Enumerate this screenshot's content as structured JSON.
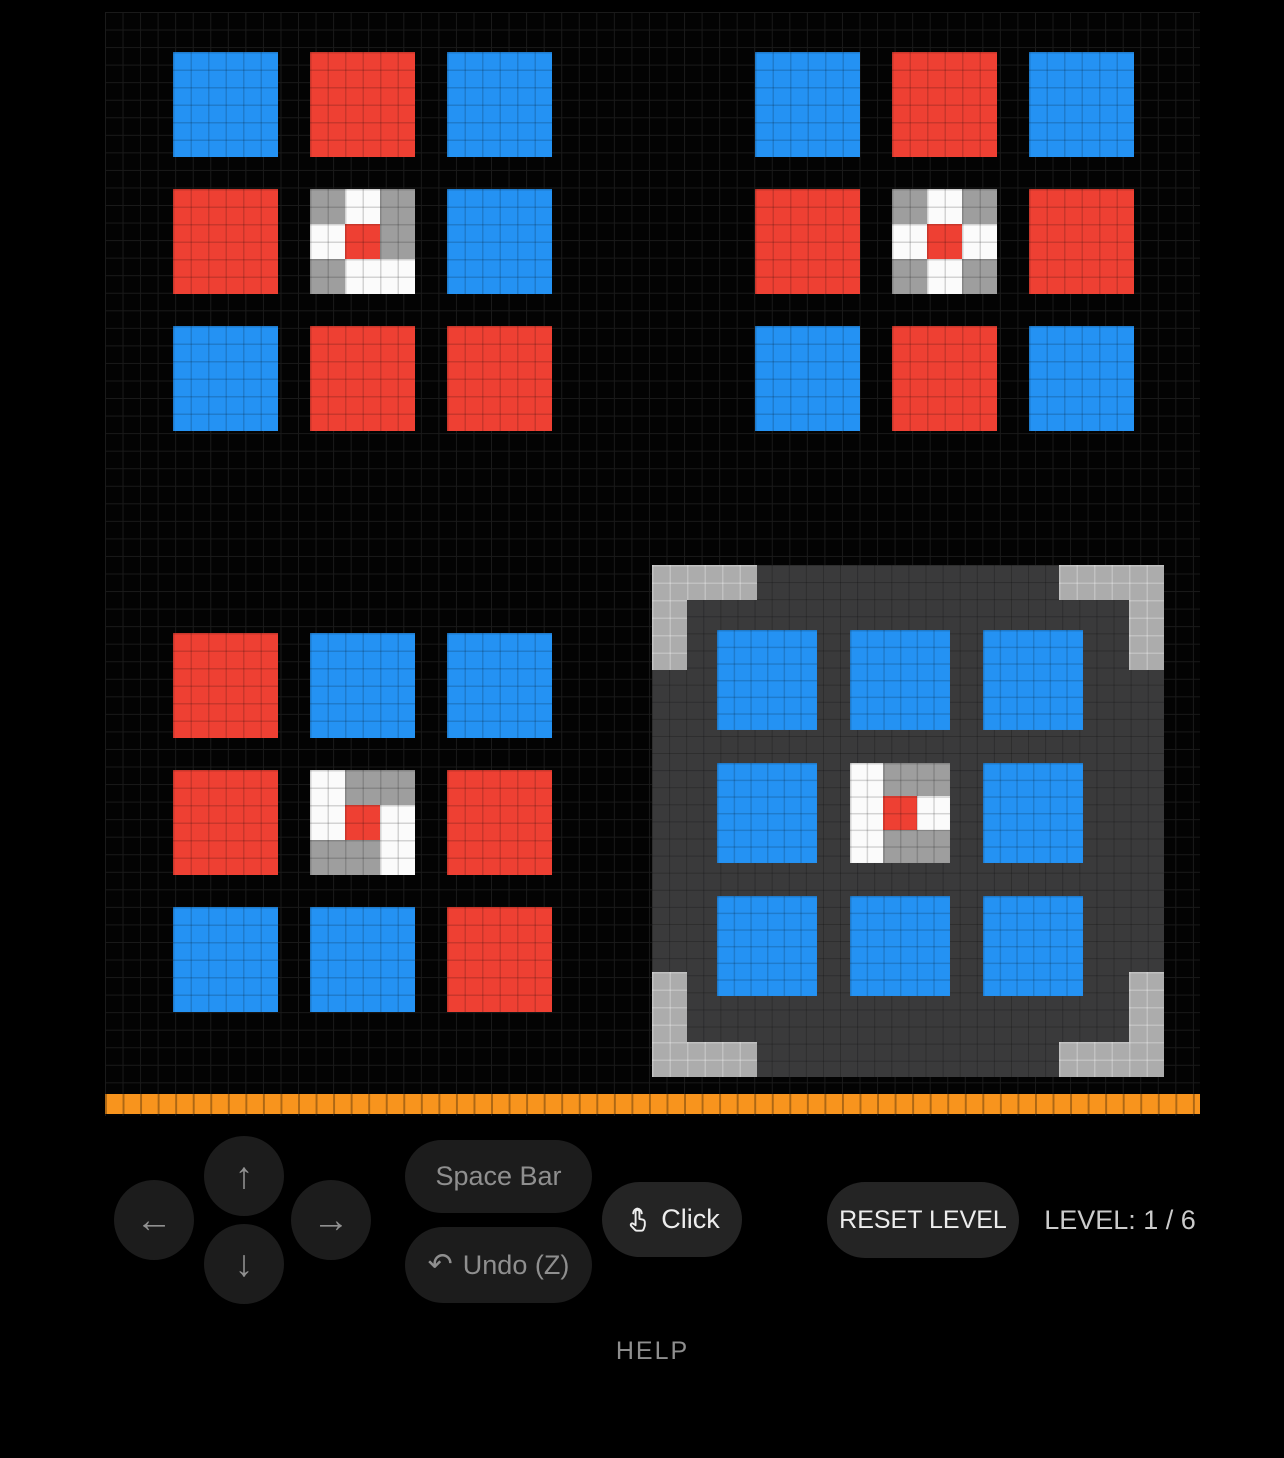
{
  "colors": {
    "background": "#000000",
    "grid_line": "#1a1a1a",
    "blue": "#2492f3",
    "red": "#ee4033",
    "orange": "#f8941d",
    "panel": "#3a3a3b",
    "bracket": "#acacac"
  },
  "tile_palette": {
    "B": "#2492f3",
    "R": "#ee4033"
  },
  "spinner_palette": {
    "W": "#fbfbfb",
    "G": "#9e9e9e",
    "R": "#ee4033"
  },
  "boards": [
    {
      "name": "pattern-board-top-left",
      "interactable": false,
      "tile_size": 105,
      "tile_pitch": 137,
      "cells": [
        [
          "B",
          "R",
          "B"
        ],
        [
          "R",
          "S",
          "B"
        ],
        [
          "B",
          "R",
          "R"
        ]
      ],
      "spinner": [
        [
          "G",
          "W",
          "G"
        ],
        [
          "W",
          "R",
          "G"
        ],
        [
          "G",
          "W",
          "W"
        ]
      ]
    },
    {
      "name": "pattern-board-top-right",
      "interactable": false,
      "tile_size": 105,
      "tile_pitch": 137,
      "cells": [
        [
          "B",
          "R",
          "B"
        ],
        [
          "R",
          "S",
          "R"
        ],
        [
          "B",
          "R",
          "B"
        ]
      ],
      "spinner": [
        [
          "G",
          "W",
          "G"
        ],
        [
          "W",
          "R",
          "W"
        ],
        [
          "G",
          "W",
          "G"
        ]
      ]
    },
    {
      "name": "pattern-board-bottom-left",
      "interactable": false,
      "tile_size": 105,
      "tile_pitch": 137,
      "cells": [
        [
          "R",
          "B",
          "B"
        ],
        [
          "R",
          "S",
          "R"
        ],
        [
          "B",
          "B",
          "R"
        ]
      ],
      "spinner": [
        [
          "W",
          "G",
          "G"
        ],
        [
          "W",
          "R",
          "W"
        ],
        [
          "G",
          "G",
          "W"
        ]
      ]
    },
    {
      "name": "main-board",
      "interactable": true,
      "tile_size": 100,
      "tile_pitch": 133,
      "cells": [
        [
          "B",
          "B",
          "B"
        ],
        [
          "B",
          "S",
          "B"
        ],
        [
          "B",
          "B",
          "B"
        ]
      ],
      "spinner": [
        [
          "W",
          "G",
          "G"
        ],
        [
          "W",
          "R",
          "W"
        ],
        [
          "W",
          "G",
          "G"
        ]
      ]
    }
  ],
  "controls": {
    "arrows": {
      "up": "↑",
      "down": "↓",
      "left": "←",
      "right": "→"
    },
    "space_bar_label": "Space Bar",
    "undo_icon": "↶",
    "undo_label": "Undo (Z)",
    "click_label": "Click",
    "reset_label": "RESET LEVEL",
    "level_label": "LEVEL: 1 / 6",
    "help_label": "HELP"
  }
}
